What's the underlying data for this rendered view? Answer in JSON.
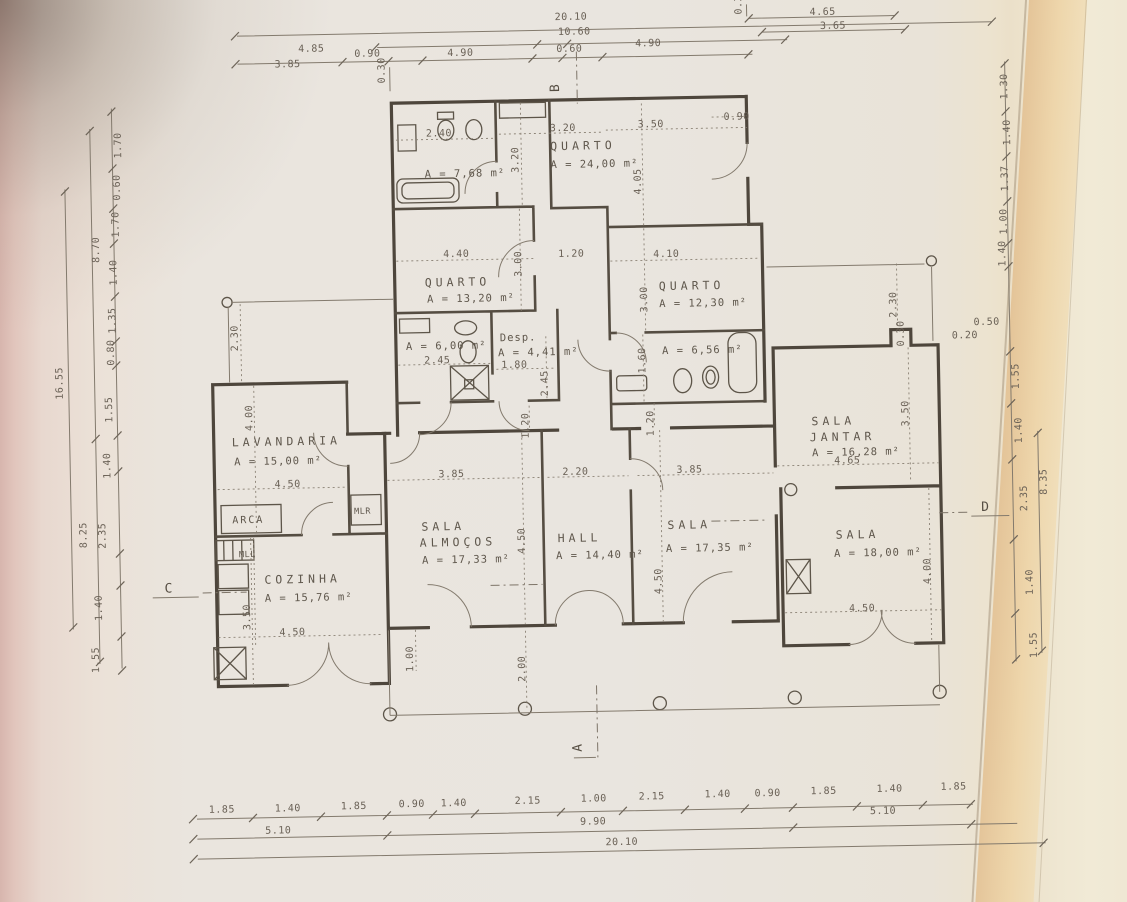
{
  "rooms": {
    "bath_top": {
      "area": "A = 7,68 m²"
    },
    "quarto24": {
      "name": "QUARTO",
      "area": "A = 24,00 m²"
    },
    "quarto13": {
      "name": "QUARTO",
      "area": "A = 13,20 m²"
    },
    "quarto12": {
      "name": "QUARTO",
      "area": "A = 12,30 m²"
    },
    "bath6": {
      "area": "A = 6,00 m²"
    },
    "desp": {
      "name": "Desp.",
      "area": "A = 4,41 m²"
    },
    "bath656": {
      "area": "A = 6,56 m²"
    },
    "lavandaria": {
      "name": "LAVANDARIA",
      "area": "A = 15,00 m²"
    },
    "cozinha": {
      "name": "COZINHA",
      "area": "A = 15,76 m²"
    },
    "sala_almocos": {
      "name1": "SALA",
      "name2": "ALMOÇOS",
      "area": "A = 17,33 m²"
    },
    "hall": {
      "name": "HALL",
      "area": "A = 14,40 m²"
    },
    "sala_estar": {
      "name": "SALA",
      "area": "A = 17,35 m²"
    },
    "sala_jantar": {
      "name1": "SALA",
      "name2": "JANTAR",
      "area": "A = 16,28 m²"
    },
    "sala": {
      "name": "SALA",
      "area": "A = 18,00 m²"
    }
  },
  "fixtures": {
    "arca": "ARCA",
    "mlr": "MLR",
    "mll": "MLL"
  },
  "section_markers": {
    "a": "A",
    "b": "B",
    "c": "C",
    "d": "D"
  },
  "dims": {
    "overall_w": "20.10",
    "top_mid": "10.60",
    "top_c": "0.60",
    "top_l1": "4.85",
    "top_l2": "3.85",
    "top_l3": "0.90",
    "top_l4": "4.90",
    "top_r4": "4.90",
    "top_right1": "4.65",
    "top_right2": "3.65",
    "top_v1": "0.30",
    "top_v2": "0.30",
    "bath_top_w": "2.40",
    "lobby_v": "3.20",
    "lobby_h": "3.20",
    "q24_w": "3.50",
    "q24_h": "4.05",
    "q24_door": "0.90",
    "q13_w": "4.40",
    "q13_h": "3.00",
    "cor_top": "1.20",
    "q12_w": "4.10",
    "q12_h": "3.00",
    "bath6_w": "2.45",
    "desp_w": "1.80",
    "desp_h": "2.45",
    "bath656_h": "1.60",
    "cor1": "1.20",
    "cor2": "1.20",
    "lav_w": "4.50",
    "lav_h": "4.00",
    "lav_top": "2.30",
    "coz_w": "4.50",
    "coz_h": "3.50",
    "alm_w": "3.85",
    "alm_h": "4.50",
    "hall_w": "2.20",
    "sala_w": "3.85",
    "sala_h": "4.50",
    "jantar_w": "4.65",
    "jantar_h": "3.50",
    "jantar_top": "2.30",
    "jantar_notch": "0.30",
    "r_off1": "0.50",
    "r_off2": "0.20",
    "sala18_w": "4.50",
    "sala18_h": "4.00",
    "porch1": "1.00",
    "porch2": "2.00",
    "b1": "1.85",
    "b2": "1.40",
    "b3": "1.85",
    "b4": "0.90",
    "b5": "1.40",
    "b6": "2.15",
    "b7": "1.00",
    "b8": "2.15",
    "b9": "1.40",
    "b10": "0.90",
    "b11": "1.85",
    "b12": "1.40",
    "b13": "1.85",
    "b_sub1": "5.10",
    "b_sub2": "9.90",
    "b_sub3": "5.10",
    "b_total": "20.10",
    "l1": "1.70",
    "l2": "0.60",
    "l3": "1.70",
    "l4": "1.40",
    "l5": "1.35",
    "l6": "0.80",
    "l7": "1.55",
    "l8": "1.40",
    "l9": "2.35",
    "l10": "1.40",
    "l11": "1.55",
    "l_sub1": "8.70",
    "l_sub2": "8.25",
    "l_total": "16.55",
    "r1": "1.30",
    "r2": "1.40",
    "r3": "1.37",
    "r4": "1.00",
    "r5": "1.40",
    "r6": "1.55",
    "r7": "1.40",
    "r8": "2.35",
    "r9": "1.40",
    "r10": "1.55",
    "r_sub": "8.35"
  },
  "colors": {
    "paper": "#eae5de",
    "ink": "#5f574c",
    "wall": "#4e463c",
    "tint_left": "#e1c5bc",
    "tint_right": "#eed2a2"
  }
}
